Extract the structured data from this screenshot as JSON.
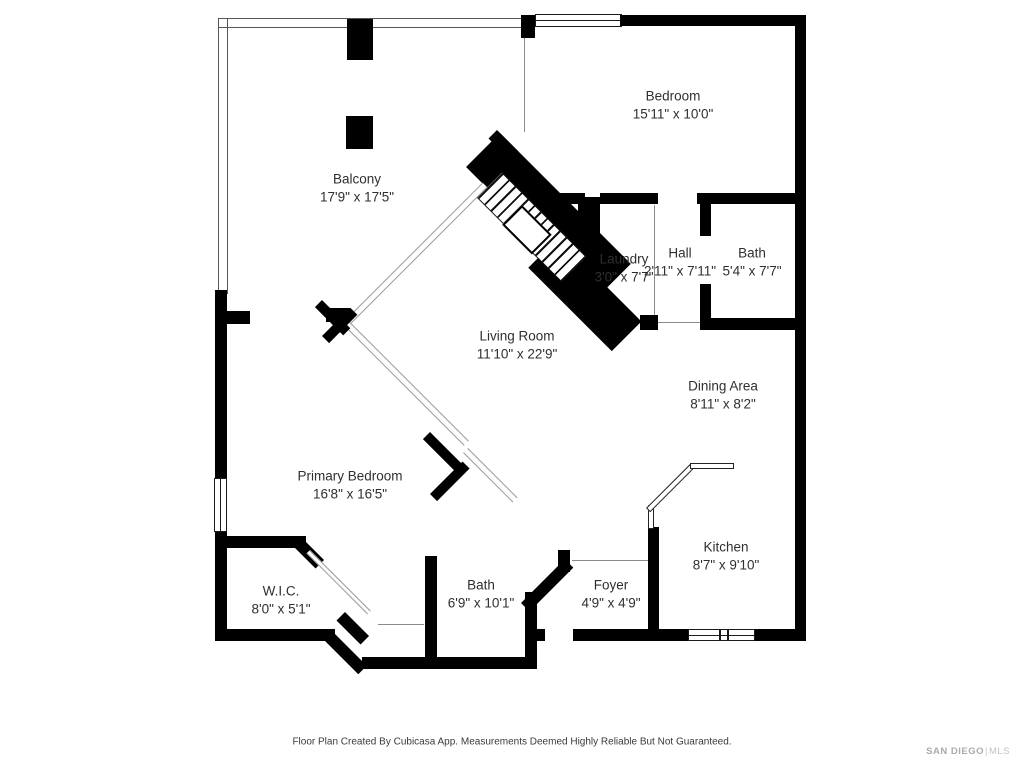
{
  "rooms": {
    "bedroom": {
      "name": "Bedroom",
      "dims": "15'11\" x 10'0\""
    },
    "balcony": {
      "name": "Balcony",
      "dims": "17'9\" x 17'5\""
    },
    "laundry": {
      "name": "Laundry",
      "dims": "3'0\" x 7'7\""
    },
    "hall": {
      "name": "Hall",
      "dims": "2'11\" x 7'11\""
    },
    "bath_upper": {
      "name": "Bath",
      "dims": "5'4\" x 7'7\""
    },
    "living_room": {
      "name": "Living Room",
      "dims": "11'10\" x 22'9\""
    },
    "dining_area": {
      "name": "Dining Area",
      "dims": "8'11\" x 8'2\""
    },
    "primary_bedroom": {
      "name": "Primary Bedroom",
      "dims": "16'8\" x 16'5\""
    },
    "kitchen": {
      "name": "Kitchen",
      "dims": "8'7\" x 9'10\""
    },
    "wic": {
      "name": "W.I.C.",
      "dims": "8'0\" x 5'1\""
    },
    "bath_lower": {
      "name": "Bath",
      "dims": "6'9\" x 10'1\""
    },
    "foyer": {
      "name": "Foyer",
      "dims": "4'9\" x 4'9\""
    }
  },
  "footer": {
    "disclaimer": "Floor Plan Created By Cubicasa App. Measurements Deemed Highly Reliable But Not Guaranteed."
  },
  "watermark": {
    "brand": "SAN DIEGO",
    "divider": "|",
    "suffix": "MLS"
  },
  "colors": {
    "wall": "#000000",
    "label_text": "#2f2f2f",
    "watermark": "#b9b9b9",
    "background": "#ffffff"
  }
}
